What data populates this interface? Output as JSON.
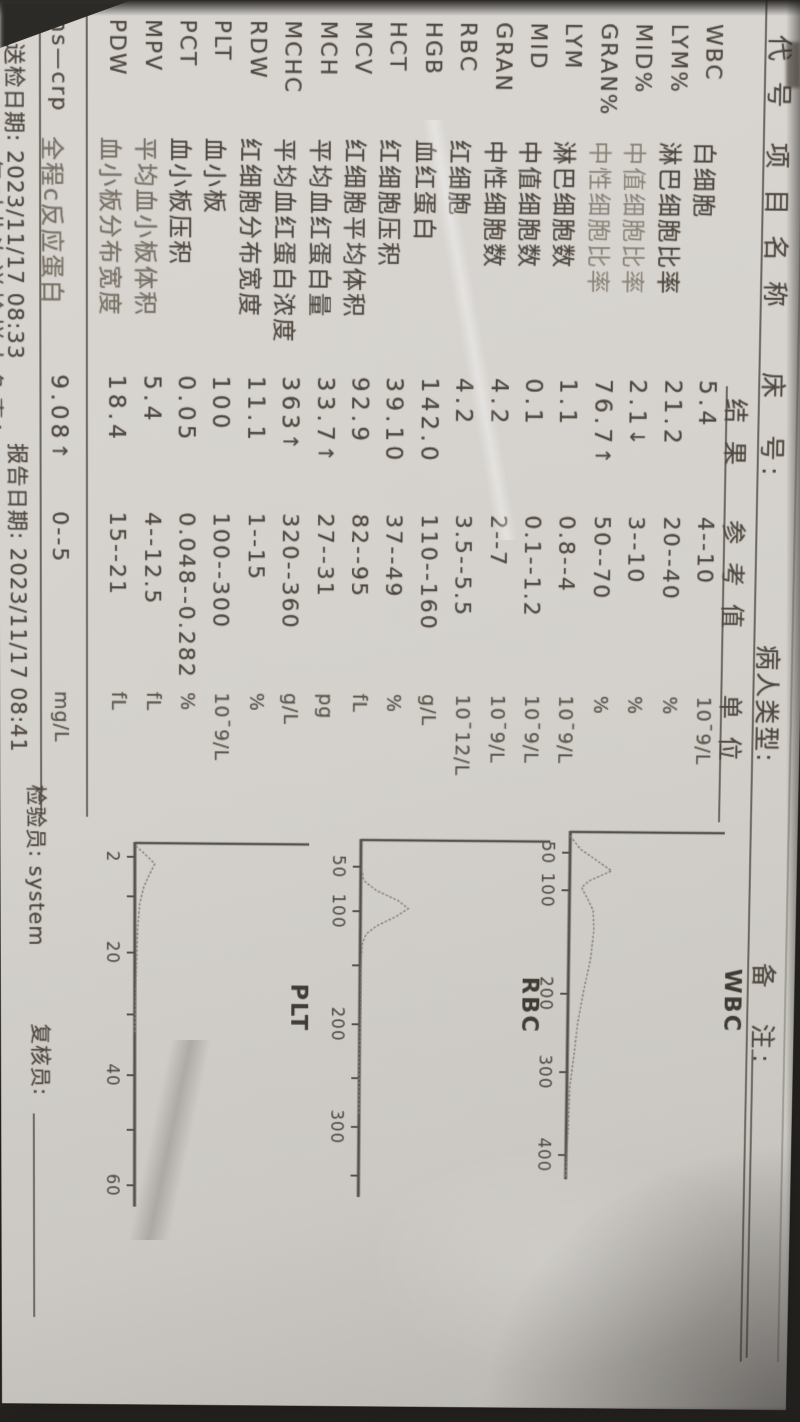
{
  "colors": {
    "background": "#262421",
    "paper": "#d6d3cf",
    "ink": "#4e4840",
    "ink_faded": "#8a8377",
    "rule": "#6b665e"
  },
  "header": {
    "top_row": {
      "code": "代 号",
      "name": "项 目 名 称",
      "bed": "床　号:",
      "patient_type": "病人类型:",
      "remark": "备　注:"
    },
    "columns": {
      "result": "结 果",
      "reference": "参 考 值",
      "unit": "单 位"
    }
  },
  "rows": [
    {
      "code": "WBC",
      "name": "白细胞",
      "result": "5.4",
      "flag": "",
      "reference": "4--10",
      "unit": "10¯9/L"
    },
    {
      "code": "LYM%",
      "name": "淋巴细胞比率",
      "result": "21.2",
      "flag": "",
      "reference": "20--40",
      "unit": "%"
    },
    {
      "code": "MID%",
      "name": "中值细胞比率",
      "result": "2.1",
      "flag": "↓",
      "reference": "3--10",
      "unit": "%"
    },
    {
      "code": "GRAN%",
      "name": "中性细胞比率",
      "result": "76.7",
      "flag": "↑",
      "reference": "50--70",
      "unit": "%"
    },
    {
      "code": "LYM",
      "name": "淋巴细胞数",
      "result": "1.1",
      "flag": "",
      "reference": "0.8--4",
      "unit": "10¯9/L"
    },
    {
      "code": "MID",
      "name": "中值细胞数",
      "result": "0.1",
      "flag": "",
      "reference": "0.1--1.2",
      "unit": "10¯9/L"
    },
    {
      "code": "GRAN",
      "name": "中性细胞数",
      "result": "4.2",
      "flag": "",
      "reference": "2--7",
      "unit": "10¯9/L"
    },
    {
      "code": "RBC",
      "name": "红细胞",
      "result": "4.2",
      "flag": "",
      "reference": "3.5--5.5",
      "unit": "10¯12/L"
    },
    {
      "code": "HGB",
      "name": "血红蛋白",
      "result": "142.0",
      "flag": "",
      "reference": "110--160",
      "unit": "g/L"
    },
    {
      "code": "HCT",
      "name": "红细胞压积",
      "result": "39.10",
      "flag": "",
      "reference": "37--49",
      "unit": "%"
    },
    {
      "code": "MCV",
      "name": "红细胞平均体积",
      "result": "92.9",
      "flag": "",
      "reference": "82--95",
      "unit": "fL"
    },
    {
      "code": "MCH",
      "name": "平均血红蛋白量",
      "result": "33.7",
      "flag": "↑",
      "reference": "27--31",
      "unit": "pg"
    },
    {
      "code": "MCHC",
      "name": "平均血红蛋白浓度",
      "result": "363",
      "flag": "↑",
      "reference": "320--360",
      "unit": "g/L"
    },
    {
      "code": "RDW",
      "name": "红细胞分布宽度",
      "result": "11.1",
      "flag": "",
      "reference": "1--15",
      "unit": "%"
    },
    {
      "code": "PLT",
      "name": "血小板",
      "result": "100",
      "flag": "",
      "reference": "100--300",
      "unit": "10¯9/L"
    },
    {
      "code": "PCT",
      "name": "血小板压积",
      "result": "0.05",
      "flag": "",
      "reference": "0.048--0.282",
      "unit": "%"
    },
    {
      "code": "MPV",
      "name": "平均血小板体积",
      "result": "5.4",
      "flag": "",
      "reference": "4--12.5",
      "unit": "fL"
    },
    {
      "code": "PDW",
      "name": "血小板分布宽度",
      "result": "18.4",
      "flag": "",
      "reference": "15--21",
      "unit": "fL"
    }
  ],
  "crp_row": {
    "code": "hs—crp",
    "name": "全程c反应蛋白",
    "result": "9.08",
    "flag": "↑",
    "reference": "0--5",
    "unit": "mg/L"
  },
  "footer": {
    "sample_date_label": "送检日期:",
    "sample_date": "2023/11/17 08:33",
    "report_date_label": "报告日期:",
    "report_date": "2023/11/17 08:41",
    "inspector_label": "检验员:",
    "inspector": "system",
    "reviewer_label": "复核员:",
    "reviewer": "",
    "disclaimer_partial": "仅对此次送检样本负责!"
  },
  "chart_data": [
    {
      "type": "area",
      "title": "WBC",
      "x_axis_unit": "fL",
      "x_range": [
        0,
        420
      ],
      "grid": false,
      "legend": false,
      "tick_labels": [
        "50",
        "100",
        "200",
        "300",
        "400"
      ],
      "ticks": [
        {
          "label": "50",
          "px": 22
        },
        {
          "label": "100",
          "px": 60
        },
        {
          "label": "200",
          "px": 165
        },
        {
          "label": "300",
          "px": 245
        },
        {
          "label": "400",
          "px": 330
        }
      ],
      "axis_len": 355,
      "plot_h": 155,
      "origin": [
        830,
        228
      ],
      "label_xy": [
        138,
        -158
      ],
      "curve": [
        [
          5,
          0
        ],
        [
          18,
          10
        ],
        [
          40,
          42
        ],
        [
          50,
          20
        ],
        [
          57,
          12
        ],
        [
          68,
          18
        ],
        [
          80,
          24
        ],
        [
          100,
          25
        ],
        [
          130,
          22
        ],
        [
          165,
          15
        ],
        [
          195,
          10
        ],
        [
          225,
          7
        ],
        [
          260,
          3
        ],
        [
          300,
          2
        ],
        [
          330,
          1
        ],
        [
          352,
          0
        ]
      ]
    },
    {
      "type": "area",
      "title": "RBC",
      "x_axis_unit": "fL",
      "x_range": [
        0,
        400
      ],
      "grid": false,
      "legend": false,
      "tick_labels": [
        "50",
        "100",
        "200",
        "300"
      ],
      "ticks": [
        {
          "label": "50",
          "px": 28
        },
        {
          "label": "100",
          "px": 73
        },
        {
          "label": "",
          "px": 128
        },
        {
          "label": "200",
          "px": 188
        },
        {
          "label": "",
          "px": 243
        },
        {
          "label": "300",
          "px": 293
        },
        {
          "label": "",
          "px": 343
        }
      ],
      "axis_len": 365,
      "plot_h": 190,
      "origin": [
        840,
        438
      ],
      "label_xy": [
        138,
        -164
      ],
      "curve": [
        [
          30,
          1
        ],
        [
          42,
          3
        ],
        [
          52,
          16
        ],
        [
          62,
          38
        ],
        [
          70,
          48
        ],
        [
          78,
          36
        ],
        [
          88,
          16
        ],
        [
          96,
          6
        ],
        [
          106,
          2
        ],
        [
          130,
          1
        ],
        [
          170,
          1
        ],
        [
          220,
          0
        ],
        [
          280,
          0
        ]
      ]
    },
    {
      "type": "area",
      "title": "PLT",
      "x_axis_unit": "fL",
      "x_range": [
        0,
        62
      ],
      "grid": false,
      "legend": false,
      "tick_labels": [
        "2",
        "20",
        "40",
        "60"
      ],
      "ticks": [
        {
          "label": "2",
          "px": 15
        },
        {
          "label": "",
          "px": 55
        },
        {
          "label": "20",
          "px": 112
        },
        {
          "label": "",
          "px": 175
        },
        {
          "label": "40",
          "px": 237
        },
        {
          "label": "",
          "px": 293
        },
        {
          "label": "60",
          "px": 350
        }
      ],
      "axis_len": 372,
      "plot_h": 175,
      "origin": [
        845,
        665
      ],
      "label_xy": [
        142,
        -158
      ],
      "curve": [
        [
          4,
          1
        ],
        [
          12,
          10
        ],
        [
          22,
          20
        ],
        [
          30,
          16
        ],
        [
          45,
          9
        ],
        [
          62,
          5
        ],
        [
          85,
          3
        ],
        [
          115,
          2
        ],
        [
          150,
          1
        ],
        [
          195,
          0
        ]
      ]
    }
  ]
}
